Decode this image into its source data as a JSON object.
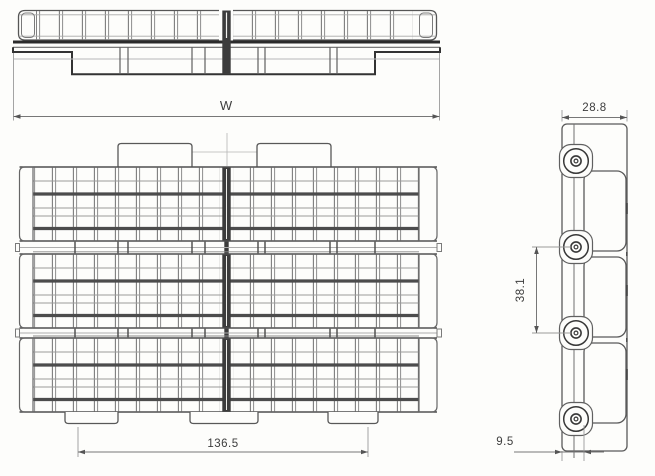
{
  "drawing": {
    "type": "engineering-drawing",
    "subject": "plastic modular conveyor belt - three view dimensional drawing",
    "dimensions": {
      "overall_width": "W",
      "module_edge_width": "28.8",
      "row_pitch": "38.1",
      "base_indent_width": "136.5",
      "pin_edge_offset": "9.5"
    },
    "colors": {
      "background": "#fdfdfb",
      "line_dark": "#2b2b2b",
      "line_medium": "#5a5a5a",
      "line_light": "#9a9a9a",
      "dim_text": "#3d3d3d",
      "seam_fill": "#3c3c3c"
    }
  }
}
